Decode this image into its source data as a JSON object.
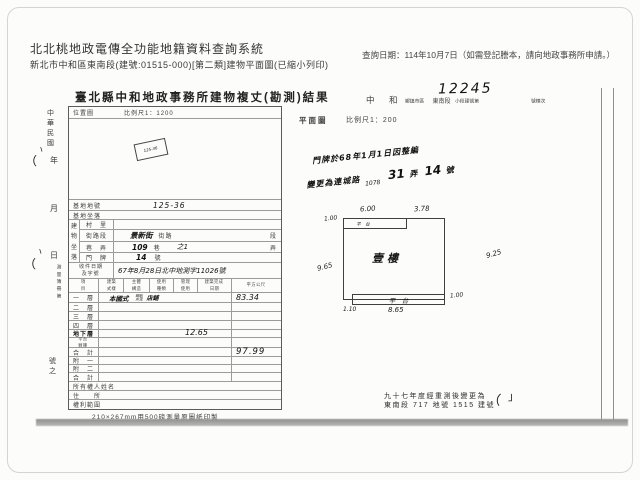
{
  "header": {
    "title": "北北桃地政電傳全功能地籍資料查詢系統",
    "subtitle": "新北市中和區東南段(建號:01515-000)[第二類]建物平面圖(已縮小列印)",
    "query_date": "查詢日期：114年10月7日（如需登記謄本，請向地政事務所申請。）"
  },
  "doc": {
    "title": "臺北縣中和地政事務所建物複丈(勘測)結果",
    "serial_number": "12245",
    "district_line": {
      "city": "中　和",
      "unit": "鄉鎮市區",
      "section": "東南段",
      "sub_label": "小段建號第",
      "suffix": "號棟次"
    },
    "location_map": {
      "label": "位置圖",
      "scale": "比例尺1：1200",
      "stamp": "125-36"
    },
    "plan_header": {
      "label": "平面圖",
      "scale": "比例尺1：200"
    },
    "margin_col": {
      "era": [
        "中",
        "華",
        "民",
        "國"
      ],
      "year": "年",
      "month": "月",
      "day": "日",
      "book": [
        "測",
        "量",
        "簿",
        "冊",
        "第"
      ],
      "tail": [
        "號",
        "之"
      ]
    },
    "fields": {
      "parcel": {
        "label": "基地地號",
        "value": "125-36"
      },
      "site": {
        "label": "基地坐落",
        "value": ""
      },
      "bldg_group": [
        "建",
        "物",
        "坐",
        "落"
      ],
      "village": {
        "label": "村　里"
      },
      "street": {
        "label": "街路段",
        "hand": "景新街",
        "print": "街路",
        "unit": "段"
      },
      "lane": {
        "label": "巷　弄",
        "no": "109",
        "unit_mid": "巷",
        "sub": "之1",
        "unit": "弄"
      },
      "door": {
        "label": "門　牌",
        "no": "14",
        "unit": "號"
      },
      "file": {
        "label1": "收件日期",
        "label2": "及字號",
        "value": "67年8月28日北中地測字11026號"
      }
    },
    "floor_table": {
      "headers": [
        {
          "l1": "項",
          "l2": "目"
        },
        {
          "l1": "建築",
          "l2": "式樣"
        },
        {
          "l1": "主體",
          "l2": "構造"
        },
        {
          "l1": "使用",
          "l2": "種類"
        },
        {
          "l1": "管理",
          "l2": "使用"
        },
        {
          "l1": "建築完成",
          "l2": "日期"
        },
        {
          "l1": "平方公尺",
          "l2": ""
        }
      ],
      "rows": [
        {
          "label": "一　層",
          "hand_style": "本國式",
          "hand_struct_l1": "鋼筋",
          "hand_struct_l2": "水泥",
          "hand_use": "店鋪",
          "area": "83.34"
        },
        {
          "label": "二　層",
          "area": ""
        },
        {
          "label": "三　層",
          "area": ""
        },
        {
          "label": "四　層",
          "area": ""
        },
        {
          "label": "地下層",
          "area": "12.65"
        },
        {
          "label1": "平台",
          "label2": "騎樓",
          "area": ""
        },
        {
          "label": "合　計",
          "area": "97.99"
        },
        {
          "label": "附　一",
          "area": ""
        },
        {
          "label": "附　二",
          "area": ""
        },
        {
          "label": "合　計",
          "area": ""
        },
        {
          "label": "所有權人姓名"
        },
        {
          "label": "住　　所"
        },
        {
          "label": "權利範圍"
        }
      ]
    },
    "paper_note": "210×267mm用500磅測量原圖紙印製",
    "address_note": {
      "line1": "門牌於68年1月1日因整編",
      "line2_prefix": "變更為連城路",
      "line2_insert": "1078",
      "line2_no1": "31",
      "line2_unit1": "弄",
      "line2_no2": "14",
      "line2_unit2": "號"
    },
    "floorplan": {
      "room": "壹樓",
      "top_strip": "平　台",
      "bottom_strip": "平　台",
      "dims": {
        "top_left": "6.00",
        "top_right": "3.78",
        "left_upper": "1.00",
        "left": "9.65",
        "right": "9.25",
        "right_lower": "1.00",
        "bottom_left": "1.10",
        "bottom": "8.65"
      }
    },
    "resurvey_note": {
      "line1": "九十七年度經重測後變更為",
      "line2": "東南段 717 地號 1515 建號"
    }
  },
  "marks": {
    "m1": "ヽ",
    "m2": "（",
    "m3": "ヽ",
    "m4": "（",
    "m5": "（",
    "m6": "」"
  }
}
